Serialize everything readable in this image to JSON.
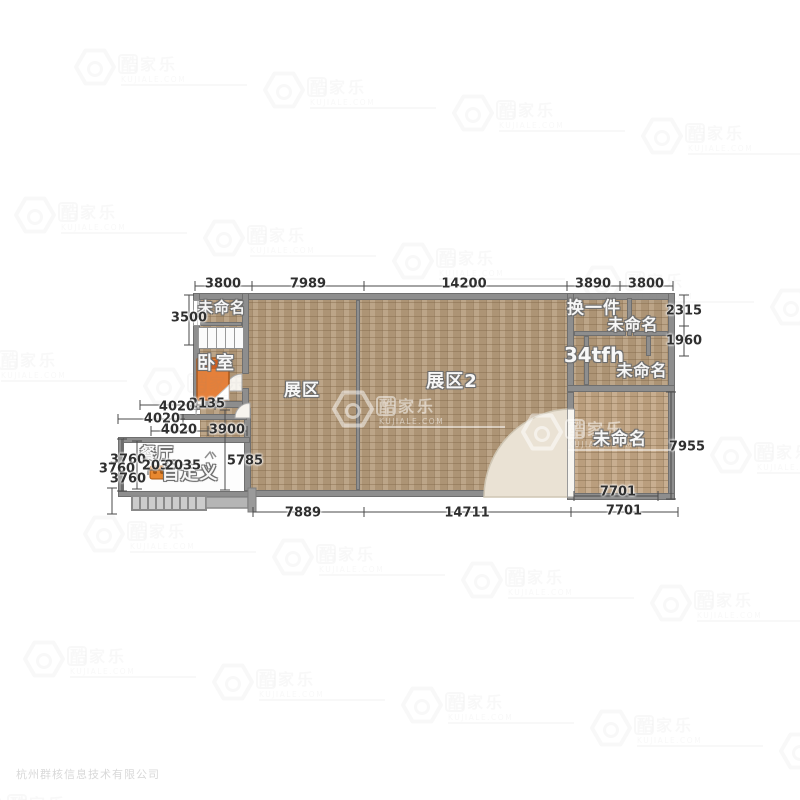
{
  "window": {
    "width": 800,
    "height": 800
  },
  "copyright": "杭州群核信息技术有限公司",
  "watermark": {
    "brand_boxed": "酷",
    "brand_rest": "家乐",
    "domain": "KUJIALE.COM"
  },
  "floorplan": {
    "rooms": {
      "unnamed_tl": "未命名",
      "bedroom": "卧室",
      "hall1": "展区",
      "hall2": "展区2",
      "swap": "换一件",
      "unnamed_tr1": "未命名",
      "code": "34tfh",
      "unnamed_tr2": "未命名",
      "unnamed_br": "未命名",
      "dining": "餐厅",
      "custom": "自定义"
    },
    "dims": {
      "top": [
        "3800",
        "7989",
        "14200",
        "3890",
        "3800"
      ],
      "right": [
        "2315",
        "1960",
        "7955"
      ],
      "bottom": [
        "7889",
        "14711",
        "7701",
        "7701"
      ],
      "left": [
        "3500",
        "2135",
        "4020",
        "4020",
        "4020",
        "3900",
        "3760",
        "3760",
        "3760",
        "2035",
        "2035",
        "5785"
      ]
    },
    "colors": {
      "floor": "#b59b7a",
      "floor_light": "#c2a583",
      "wall": "#8e8e8e",
      "bed": "#e5803a",
      "door_arc": "#eae2d4"
    }
  }
}
